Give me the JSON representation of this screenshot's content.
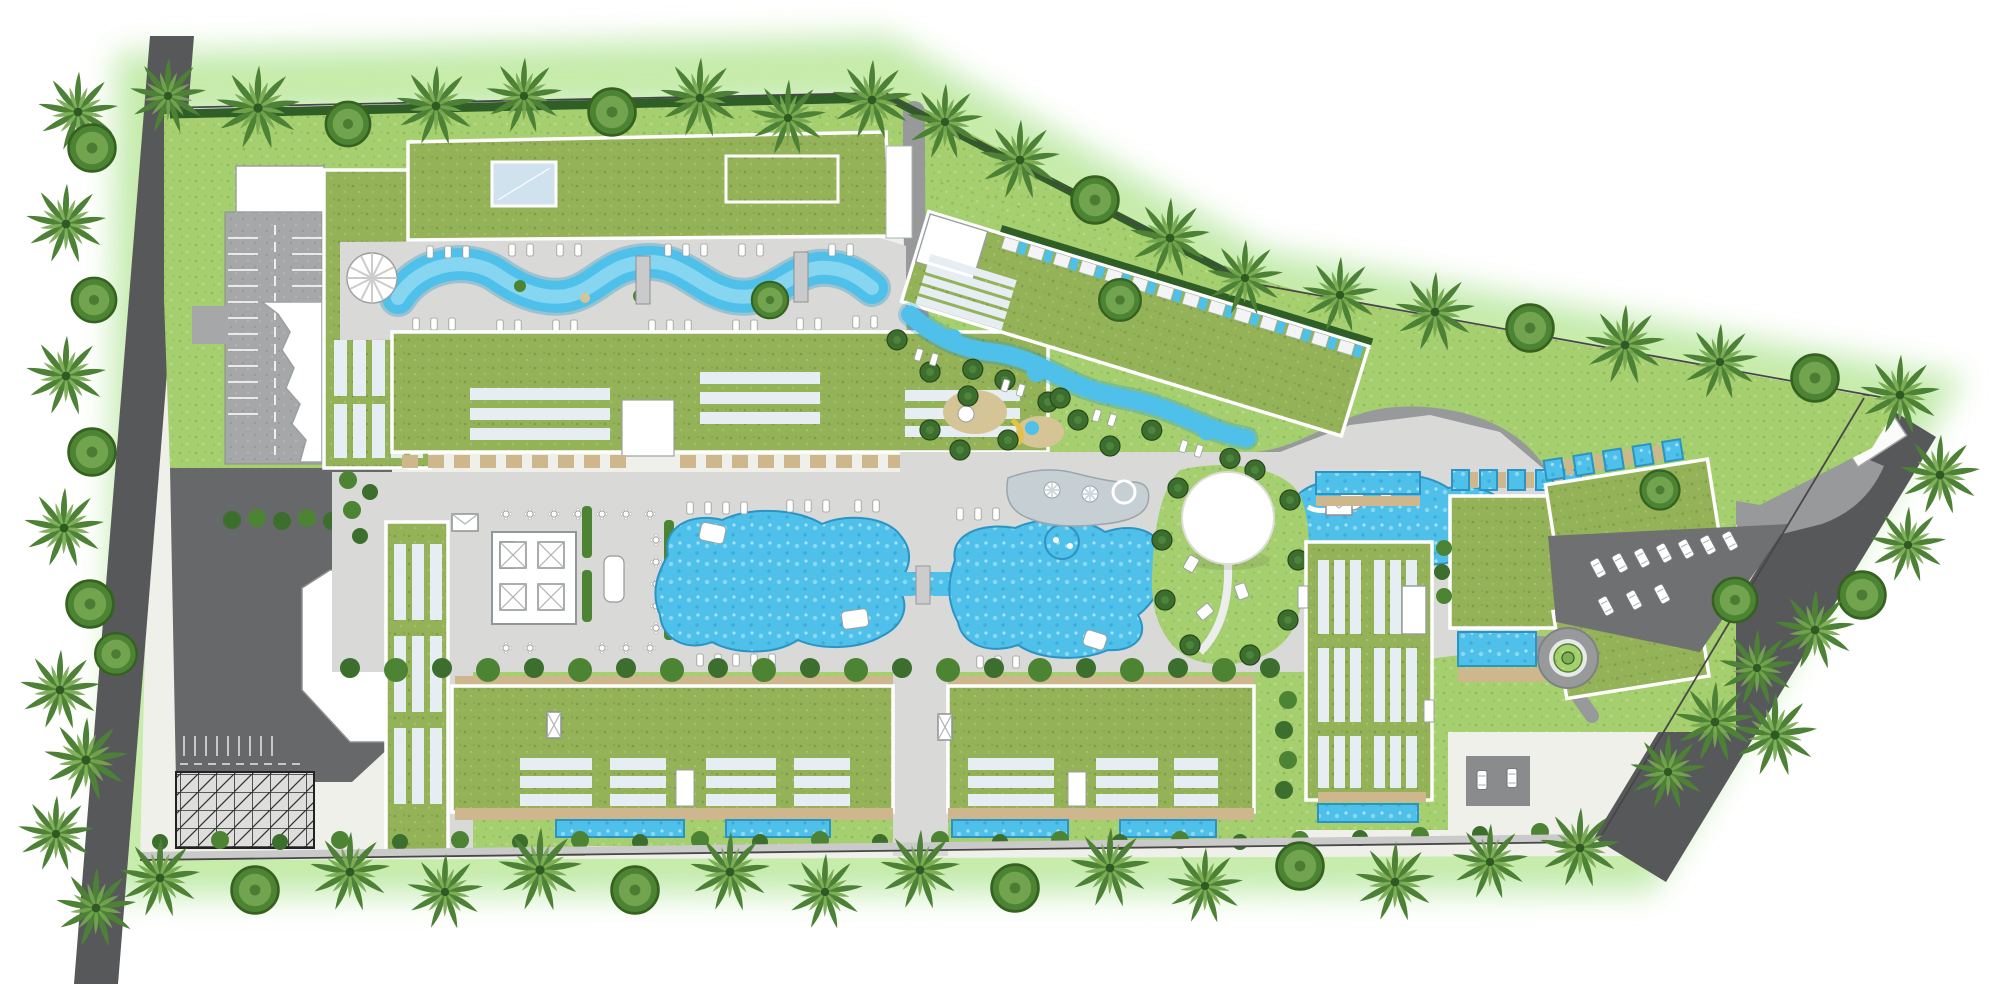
{
  "palette": {
    "lawn": "#a6cf70",
    "roof": "#94b257",
    "hedge": "#2f5f26",
    "bush": "#4d8434",
    "tree": "#3c6e2e",
    "palm": "#4c8136",
    "palmlight": "#76a84e",
    "pool": "#4fc0ea",
    "pooldeep": "#2b94c4",
    "poollight": "#b4e7f8",
    "deck": "#d9dad8",
    "pave": "#a6a7a8",
    "drive": "#97999b",
    "road": "#57585a",
    "sand": "#d5c496",
    "tan": "#cfb78d",
    "sky": "#e6edf3",
    "glass": "#cfe2ee",
    "glow": "#8fd968"
  }
}
